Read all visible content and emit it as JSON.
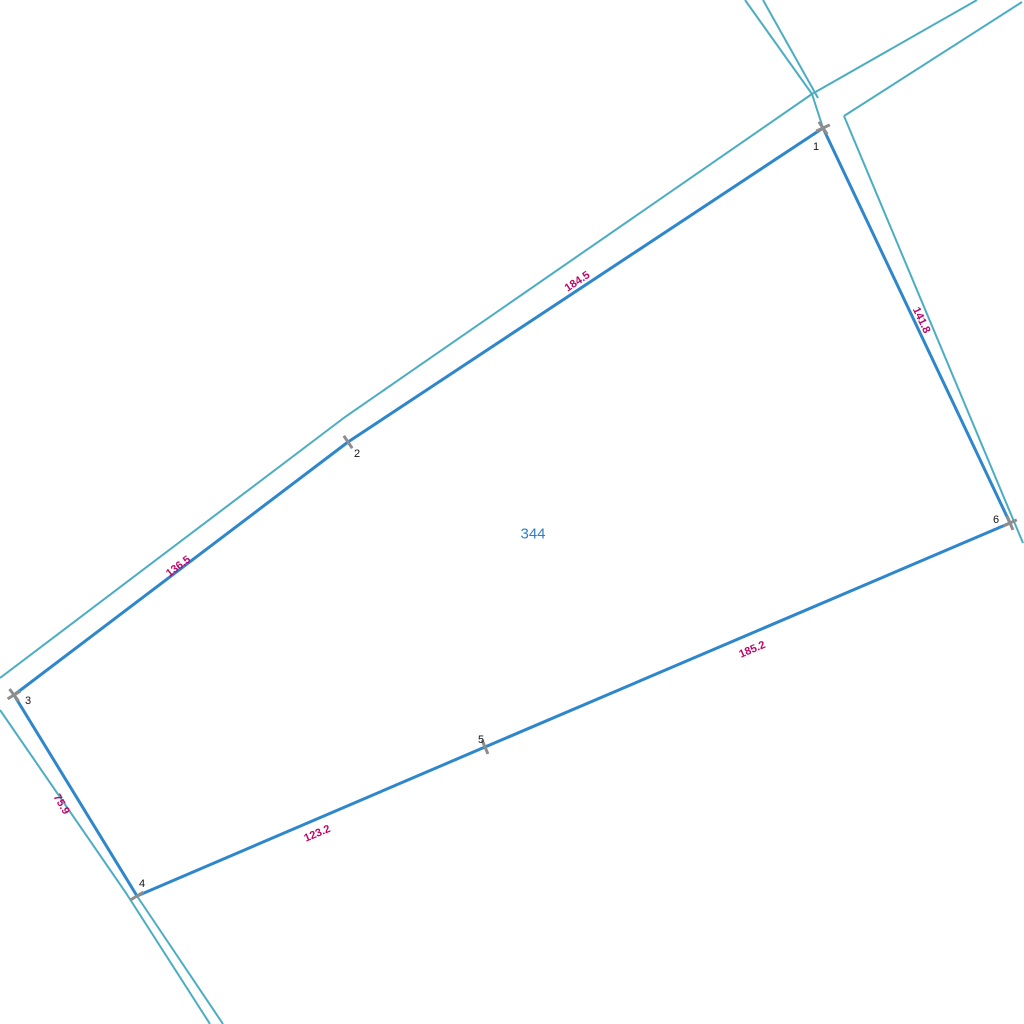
{
  "map": {
    "background": "#ffffff",
    "colors": {
      "parcel_stroke": "#2e86cb",
      "adjacent_stroke": "#4badc3",
      "edge_label": "#bd0868",
      "vertex_label": "#141414",
      "marker": "#8d8d8d",
      "parcel_label": "#2e7fc6"
    },
    "stroke_widths": {
      "parcel": 3,
      "adjacent": 2,
      "tick": 3
    },
    "parcel": {
      "number": "344",
      "label_x": 533,
      "label_y": 533,
      "vertices": [
        {
          "n": "1",
          "x": 823,
          "y": 128,
          "label_x": 816,
          "label_y": 150,
          "ticks": [
            56,
            -25
          ]
        },
        {
          "n": "2",
          "x": 348,
          "y": 442,
          "label_x": 357,
          "label_y": 457,
          "ticks": [
            56
          ]
        },
        {
          "n": "3",
          "x": 14,
          "y": 695,
          "label_x": 28,
          "label_y": 704,
          "ticks": [
            53,
            -31
          ]
        },
        {
          "n": "4",
          "x": 137,
          "y": 896,
          "label_x": 142,
          "label_y": 887,
          "ticks": [
            -31
          ]
        },
        {
          "n": "5",
          "x": 485,
          "y": 747,
          "label_x": 481,
          "label_y": 743,
          "ticks": [
            67
          ]
        },
        {
          "n": "6",
          "x": 1010,
          "y": 523,
          "label_x": 996,
          "label_y": 523,
          "ticks": [
            -25,
            67
          ]
        }
      ],
      "edge_labels": [
        {
          "text": "184.5",
          "x": 577,
          "y": 281,
          "rot": -33.5
        },
        {
          "text": "136.5",
          "x": 178,
          "y": 566,
          "rot": -37
        },
        {
          "text": "75.9",
          "x": 62,
          "y": 804,
          "rot": 60
        },
        {
          "text": "123.2",
          "x": 317,
          "y": 833,
          "rot": -23
        },
        {
          "text": "185.2",
          "x": 752,
          "y": 649,
          "rot": -23
        },
        {
          "text": "141.8",
          "x": 922,
          "y": 320,
          "rot": 65
        }
      ]
    },
    "adjacent_lines": [
      {
        "name": "road-casing-ne-upper",
        "points": [
          [
            977,
            0
          ],
          [
            812,
            94
          ]
        ]
      },
      {
        "name": "road-casing-ne-lower",
        "points": [
          [
            1022,
            2
          ],
          [
            844,
            116
          ]
        ]
      },
      {
        "name": "road-casing-n-left",
        "points": [
          [
            745,
            0
          ],
          [
            812,
            94
          ]
        ]
      },
      {
        "name": "road-casing-n-right",
        "points": [
          [
            763,
            0
          ],
          [
            818,
            98
          ]
        ]
      },
      {
        "name": "junction-connector",
        "points": [
          [
            812,
            94
          ],
          [
            823,
            128
          ]
        ]
      },
      {
        "name": "casing-above-edge-1-2-3",
        "points": [
          [
            812,
            94
          ],
          [
            345,
            417
          ],
          [
            0,
            678
          ]
        ]
      },
      {
        "name": "casing-right-of-edge-1-6",
        "points": [
          [
            844,
            116
          ],
          [
            1023,
            543
          ]
        ]
      },
      {
        "name": "casing-left-of-edge-3-4",
        "points": [
          [
            0,
            710
          ],
          [
            126,
            893
          ],
          [
            210,
            1024
          ]
        ]
      },
      {
        "name": "boundary-extension-below-4",
        "points": [
          [
            137,
            896
          ],
          [
            223,
            1024
          ]
        ]
      }
    ]
  }
}
